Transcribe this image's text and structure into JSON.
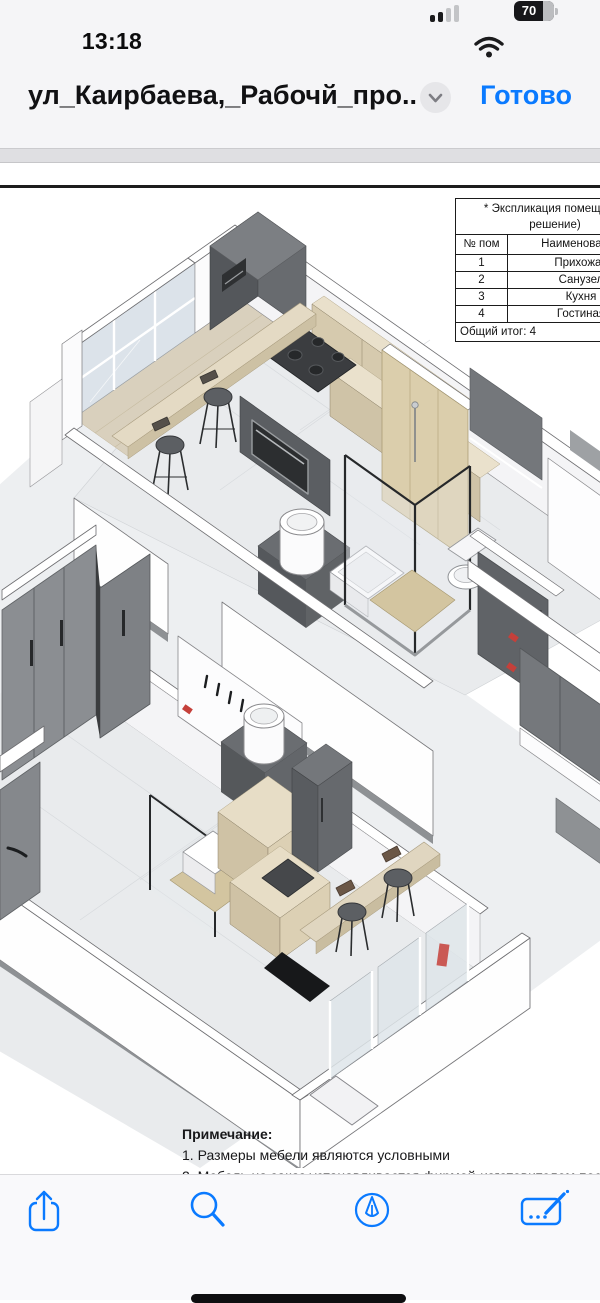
{
  "status_bar": {
    "time": "13:18",
    "battery_percent": "70"
  },
  "title_bar": {
    "title": "ул_Каирбаева,_Рабочй_про...",
    "done_label": "Готово"
  },
  "document": {
    "legend_table": {
      "title_line1": "* Экспликация помещений",
      "title_line2": "решение)",
      "col_num": "№ пом",
      "col_name": "Наименование",
      "rows": [
        [
          "1",
          "Прихожая"
        ],
        [
          "2",
          "Санузел"
        ],
        [
          "3",
          "Кухня"
        ],
        [
          "4",
          "Гостиная"
        ]
      ],
      "footer": "Общий итог: 4"
    },
    "note": {
      "heading": "Примечание:",
      "line1": "1. Размеры мебели являются условными",
      "line2": "2. Мебель на заказ устанавливается фирмой-изготовителем после"
    },
    "drawing_description": "Axonometric 3D cutaway of two apartment levels with kitchen, bathroom, hallway wardrobes, bar stools and windows"
  },
  "toolbar_icons": [
    "share-icon",
    "search-icon",
    "markup-pen-icon",
    "signature-icon"
  ],
  "colors": {
    "accent_blue": "#0a7aff",
    "chrome_bg": "#f5f5f7",
    "page_white": "#ffffff",
    "table_border": "#1b1b1b",
    "wall_white": "#fdfdfe",
    "floor_tile": "#e9ebed",
    "wood": "#d8cdb4",
    "wood_top": "#e8dfc9",
    "furniture_grey": "#64676b",
    "furniture_grey_dark": "#54575b",
    "appliance_black": "#3b3d40",
    "glass": "#dce3ea",
    "red_accent": "#c5403a"
  }
}
